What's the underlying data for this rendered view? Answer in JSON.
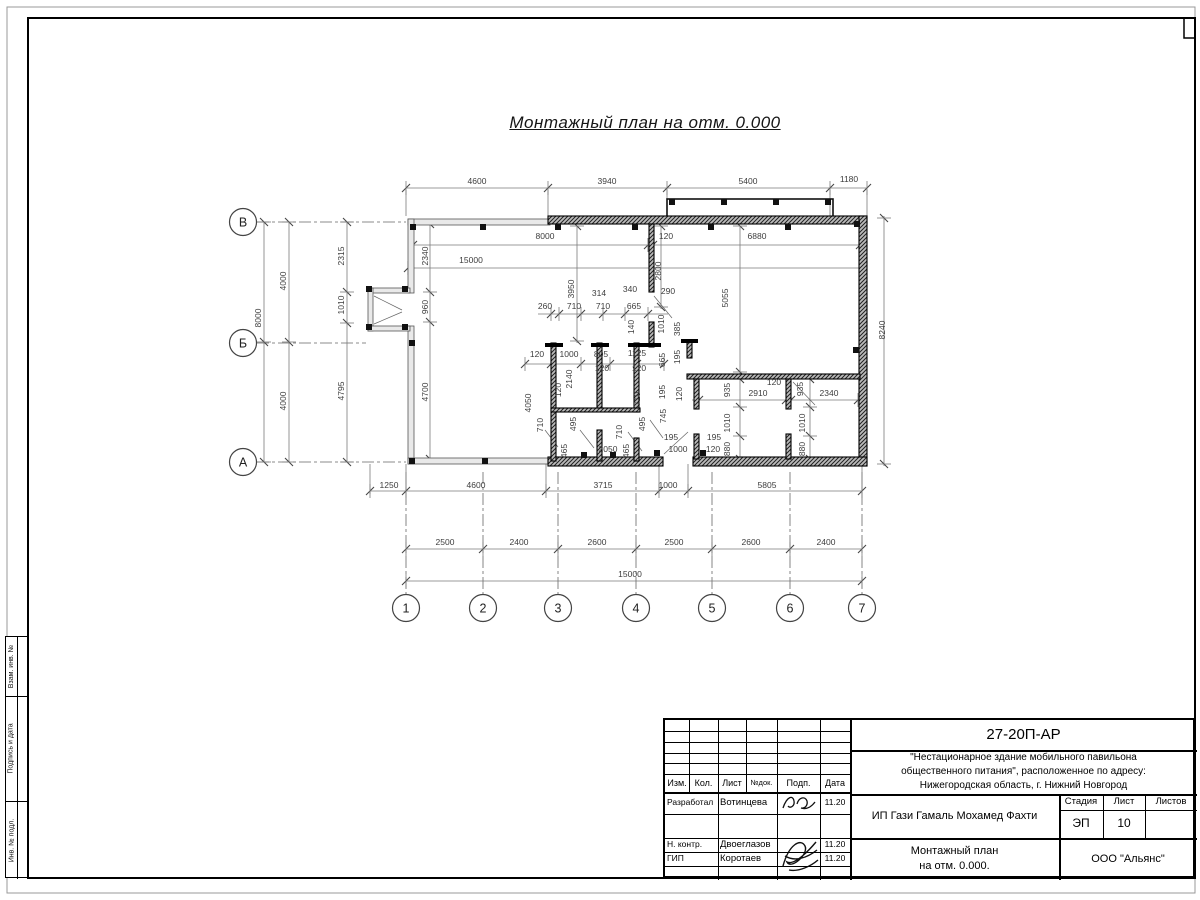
{
  "sheet": {
    "title": "Монтажный план на отм. 0.000"
  },
  "side_stamp": {
    "cells": [
      "Взам. инв. №",
      "Подпись и дата",
      "Инв. № подл."
    ]
  },
  "title_block": {
    "doc_number": "27-20П-АР",
    "project_line1": "\"Нестационарное здание мобильного павильона",
    "project_line2": "общественного питания\", расположенное по адресу:",
    "project_line3": "Нижегородская область, г. Нижний Новгород",
    "cols": [
      "Изм.",
      "Кол.",
      "Лист",
      "№док.",
      "Подп.",
      "Дата"
    ],
    "rows": [
      {
        "role": "Разработал",
        "name": "Вотинцева",
        "date": "11.20"
      },
      {
        "role": "Н. контр.",
        "name": "Двоеглазов",
        "date": "11.20"
      },
      {
        "role": "ГИП",
        "name": "Коротаев",
        "date": "11.20"
      }
    ],
    "client": "ИП Гази Гамаль Мохамед Фахти",
    "stage_label": "Стадия",
    "sheet_label": "Лист",
    "sheets_label": "Листов",
    "stage": "ЭП",
    "sheet_num": "10",
    "sheets_total": "",
    "drawing_title_line1": "Монтажный план",
    "drawing_title_line2": "на отм. 0.000.",
    "company": "ООО \"Альянс\""
  },
  "plan": {
    "axes_bottom": [
      {
        "label": "1",
        "x": 406
      },
      {
        "label": "2",
        "x": 483
      },
      {
        "label": "3",
        "x": 558
      },
      {
        "label": "4",
        "x": 636
      },
      {
        "label": "5",
        "x": 712
      },
      {
        "label": "6",
        "x": 790
      },
      {
        "label": "7",
        "x": 862
      }
    ],
    "axes_left": [
      {
        "label": "В",
        "y": 222
      },
      {
        "label": "Б",
        "y": 343
      },
      {
        "label": "А",
        "y": 462
      }
    ],
    "dim_labels": [
      {
        "t": "4600",
        "x": 477,
        "y": 184,
        "r": 0
      },
      {
        "t": "3940",
        "x": 607,
        "y": 184,
        "r": 0
      },
      {
        "t": "5400",
        "x": 748,
        "y": 184,
        "r": 0
      },
      {
        "t": "1180",
        "x": 849,
        "y": 182,
        "r": 0
      },
      {
        "t": "8000",
        "x": 545,
        "y": 239,
        "r": 0
      },
      {
        "t": "120",
        "x": 666,
        "y": 239,
        "r": 0
      },
      {
        "t": "6880",
        "x": 757,
        "y": 239,
        "r": 0
      },
      {
        "t": "15000",
        "x": 471,
        "y": 263,
        "r": 0
      },
      {
        "t": "314",
        "x": 599,
        "y": 296,
        "r": 0
      },
      {
        "t": "340",
        "x": 630,
        "y": 292,
        "r": 0
      },
      {
        "t": "260",
        "x": 545,
        "y": 309,
        "r": 0
      },
      {
        "t": "710",
        "x": 574,
        "y": 309,
        "r": 0
      },
      {
        "t": "710",
        "x": 603,
        "y": 309,
        "r": 0
      },
      {
        "t": "665",
        "x": 634,
        "y": 309,
        "r": 0
      },
      {
        "t": "290",
        "x": 668,
        "y": 294,
        "r": 0
      },
      {
        "t": "120",
        "x": 537,
        "y": 357,
        "r": 0
      },
      {
        "t": "1000",
        "x": 569,
        "y": 357,
        "r": 0
      },
      {
        "t": "805",
        "x": 601,
        "y": 357,
        "r": 0
      },
      {
        "t": "1125",
        "x": 637,
        "y": 356,
        "r": 0
      },
      {
        "t": "120",
        "x": 602,
        "y": 371,
        "r": 0
      },
      {
        "t": "120",
        "x": 639,
        "y": 371,
        "r": 0
      },
      {
        "t": "2050",
        "x": 608,
        "y": 452,
        "r": 0
      },
      {
        "t": "1000",
        "x": 678,
        "y": 452,
        "r": 0
      },
      {
        "t": "120",
        "x": 713,
        "y": 452,
        "r": 0
      },
      {
        "t": "195",
        "x": 671,
        "y": 440,
        "r": 0
      },
      {
        "t": "195",
        "x": 714,
        "y": 440,
        "r": 0
      },
      {
        "t": "2910",
        "x": 758,
        "y": 396,
        "r": 0
      },
      {
        "t": "120",
        "x": 774,
        "y": 385,
        "r": 0
      },
      {
        "t": "2340",
        "x": 829,
        "y": 396,
        "r": 0
      },
      {
        "t": "1250",
        "x": 389,
        "y": 488,
        "r": 0
      },
      {
        "t": "4600",
        "x": 476,
        "y": 488,
        "r": 0
      },
      {
        "t": "3715",
        "x": 603,
        "y": 488,
        "r": 0
      },
      {
        "t": "1000",
        "x": 668,
        "y": 488,
        "r": 0
      },
      {
        "t": "5805",
        "x": 767,
        "y": 488,
        "r": 0
      },
      {
        "t": "2500",
        "x": 445,
        "y": 545,
        "r": 0
      },
      {
        "t": "2400",
        "x": 519,
        "y": 545,
        "r": 0
      },
      {
        "t": "2600",
        "x": 597,
        "y": 545,
        "r": 0
      },
      {
        "t": "2500",
        "x": 674,
        "y": 545,
        "r": 0
      },
      {
        "t": "2600",
        "x": 751,
        "y": 545,
        "r": 0
      },
      {
        "t": "2400",
        "x": 826,
        "y": 545,
        "r": 0
      },
      {
        "t": "15000",
        "x": 630,
        "y": 577,
        "r": 0
      },
      {
        "t": "8000",
        "x": 261,
        "y": 318,
        "r": 1
      },
      {
        "t": "4000",
        "x": 286,
        "y": 281,
        "r": 1
      },
      {
        "t": "4000",
        "x": 286,
        "y": 401,
        "r": 1
      },
      {
        "t": "2315",
        "x": 344,
        "y": 256,
        "r": 1
      },
      {
        "t": "1010",
        "x": 344,
        "y": 305,
        "r": 1
      },
      {
        "t": "4795",
        "x": 344,
        "y": 391,
        "r": 1
      },
      {
        "t": "2340",
        "x": 428,
        "y": 256,
        "r": 1
      },
      {
        "t": "960",
        "x": 428,
        "y": 307,
        "r": 1
      },
      {
        "t": "4700",
        "x": 428,
        "y": 392,
        "r": 1
      },
      {
        "t": "3950",
        "x": 574,
        "y": 289,
        "r": 1
      },
      {
        "t": "2800",
        "x": 661,
        "y": 271,
        "r": 1
      },
      {
        "t": "5055",
        "x": 728,
        "y": 298,
        "r": 1
      },
      {
        "t": "8240",
        "x": 885,
        "y": 330,
        "r": 1
      },
      {
        "t": "140",
        "x": 634,
        "y": 327,
        "r": 1
      },
      {
        "t": "1010",
        "x": 664,
        "y": 324,
        "r": 1
      },
      {
        "t": "385",
        "x": 680,
        "y": 329,
        "r": 1
      },
      {
        "t": "2140",
        "x": 572,
        "y": 379,
        "r": 1
      },
      {
        "t": "120",
        "x": 561,
        "y": 390,
        "r": 1
      },
      {
        "t": "710",
        "x": 543,
        "y": 425,
        "r": 1
      },
      {
        "t": "495",
        "x": 576,
        "y": 424,
        "r": 1
      },
      {
        "t": "465",
        "x": 567,
        "y": 451,
        "r": 1
      },
      {
        "t": "710",
        "x": 622,
        "y": 432,
        "r": 1
      },
      {
        "t": "465",
        "x": 629,
        "y": 451,
        "r": 1
      },
      {
        "t": "4050",
        "x": 531,
        "y": 403,
        "r": 1
      },
      {
        "t": "665",
        "x": 665,
        "y": 360,
        "r": 1
      },
      {
        "t": "195",
        "x": 680,
        "y": 357,
        "r": 1
      },
      {
        "t": "195",
        "x": 665,
        "y": 392,
        "r": 1
      },
      {
        "t": "120",
        "x": 682,
        "y": 394,
        "r": 1
      },
      {
        "t": "710",
        "x": 640,
        "y": 399,
        "r": 1
      },
      {
        "t": "745",
        "x": 666,
        "y": 416,
        "r": 1
      },
      {
        "t": "495",
        "x": 645,
        "y": 424,
        "r": 1
      },
      {
        "t": "935",
        "x": 730,
        "y": 390,
        "r": 1
      },
      {
        "t": "935",
        "x": 803,
        "y": 389,
        "r": 1
      },
      {
        "t": "1010",
        "x": 730,
        "y": 423,
        "r": 1
      },
      {
        "t": "880",
        "x": 730,
        "y": 449,
        "r": 1
      },
      {
        "t": "1010",
        "x": 805,
        "y": 423,
        "r": 1
      },
      {
        "t": "880",
        "x": 805,
        "y": 449,
        "r": 1
      }
    ]
  }
}
